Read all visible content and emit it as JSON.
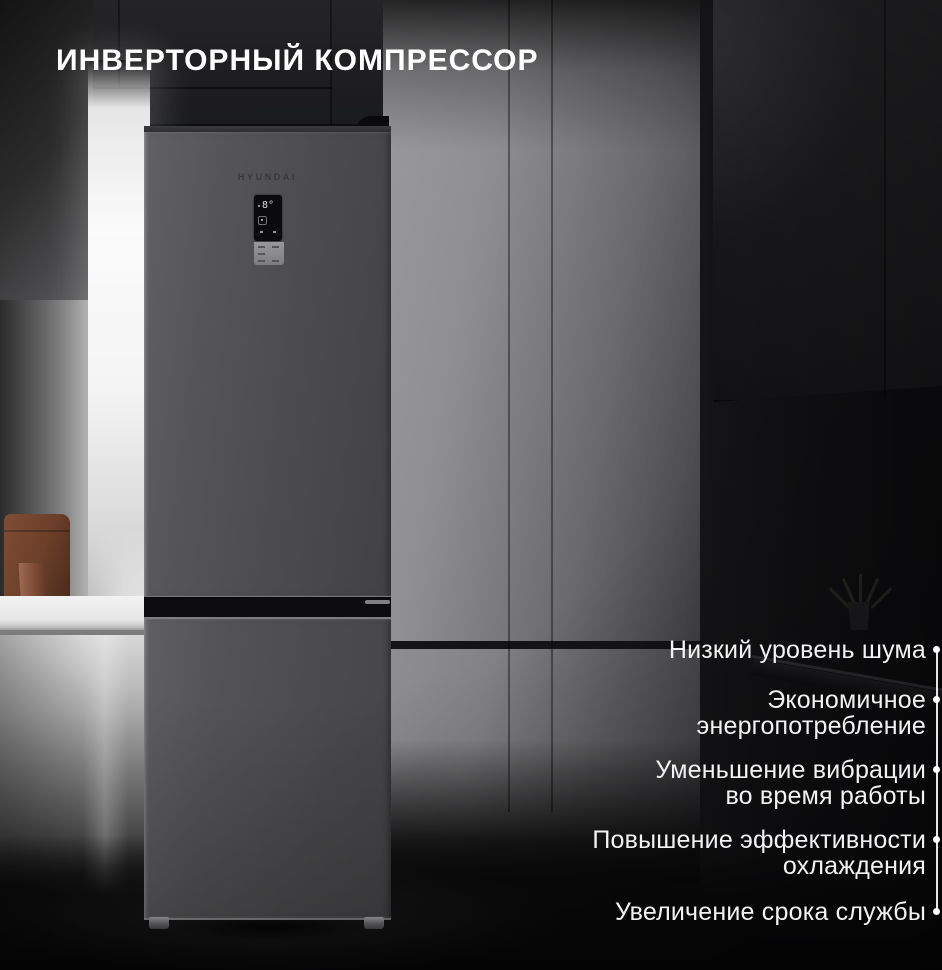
{
  "title": "ИНВЕРТОРНЫЙ КОМПРЕССОР",
  "product": {
    "brand": "HYUNDAI",
    "type": "двухкамерный холодильник",
    "display": {
      "temperature": "8°"
    }
  },
  "features": [
    {
      "line1": "Низкий уровень шума",
      "line2": ""
    },
    {
      "line1": "Экономичное",
      "line2": "энергопотребление"
    },
    {
      "line1": "Уменьшение вибрации",
      "line2": "во время работы"
    },
    {
      "line1": "Повышение эффективности",
      "line2": "охлаждения"
    },
    {
      "line1": "Увеличение срока службы",
      "line2": ""
    }
  ],
  "colors": {
    "text_white": "#ffffff",
    "fridge_body": "#4b4b4d",
    "background_dark": "#121214",
    "panel_gray": "#8f8f91",
    "bag_brown": "#6b3f29",
    "cup_terracotta": "#7c4a34"
  }
}
